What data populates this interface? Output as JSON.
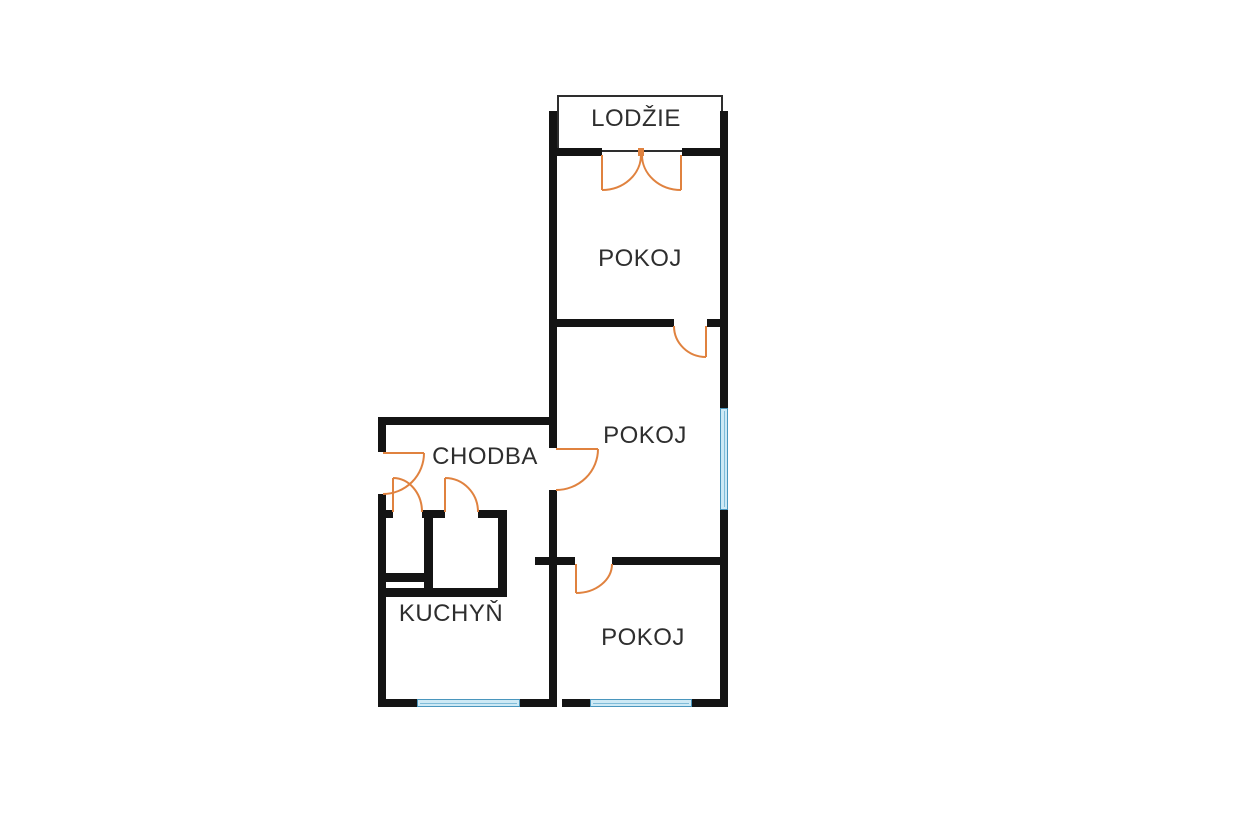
{
  "rooms": {
    "loggia": "LODŽIE",
    "room_top": "POKOJ",
    "room_middle": "POKOJ",
    "room_bottom": "POKOJ",
    "hallway": "CHODBA",
    "kitchen": "KUCHYŇ"
  },
  "colors": {
    "wall": "#141414",
    "door": "#e0823f",
    "window_fill": "#cde9f5",
    "window_border": "#4a96bd",
    "window_mid": "#7fbcd9",
    "loggia_border": "#2e2e2e",
    "text": "#2e2e2e",
    "background": "#ffffff"
  }
}
